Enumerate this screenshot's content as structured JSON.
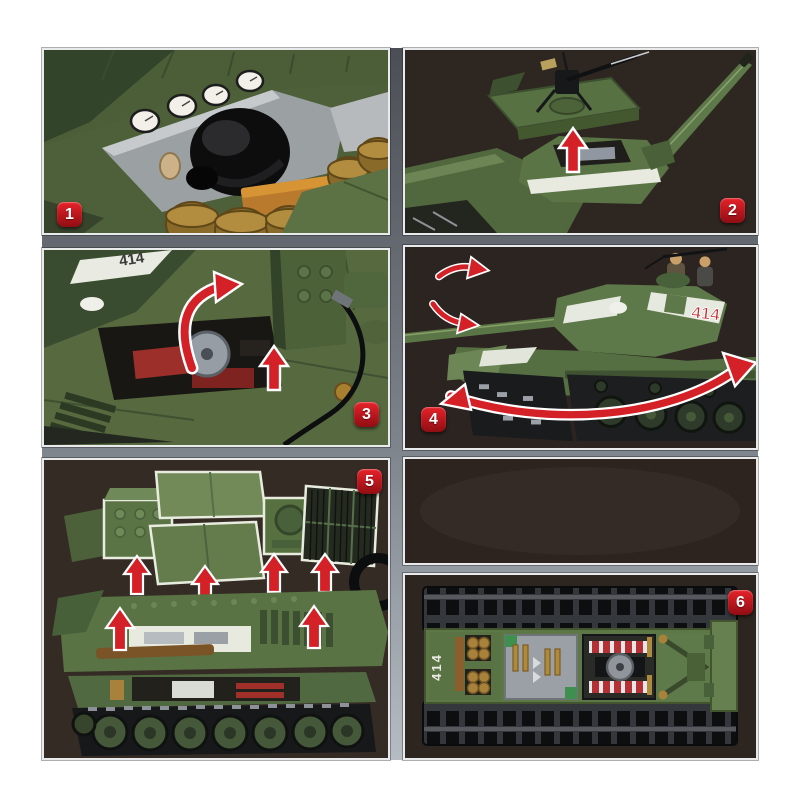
{
  "product": {
    "type": "brick-built tank model feature collage",
    "hull_marking": "414"
  },
  "colors": {
    "page_background": "#ffffff",
    "frame_gray": "#8d939b",
    "panel_photo_background": "#31281f",
    "badge_red": "#c0181f",
    "arrow_red": "#d32127",
    "army_green": "#5b7446",
    "army_green_dark": "#3c4f2f",
    "white_stripe": "#e8eadf",
    "gold_brass": "#a8813a",
    "track_black": "#17181a"
  },
  "panels": [
    {
      "id": "interior-stowage-detail",
      "badge": "1"
    },
    {
      "id": "turret-aa-gun-assembly",
      "badge": "2"
    },
    {
      "id": "engine-bay-open",
      "badge": "3",
      "marking": "414"
    },
    {
      "id": "turret-rotation",
      "badge": "4",
      "marking": "414"
    },
    {
      "id": "exploded-hull-panels",
      "badge": "5"
    },
    {
      "id": "chassis-top-view",
      "badge": "6",
      "marking": "414"
    }
  ]
}
